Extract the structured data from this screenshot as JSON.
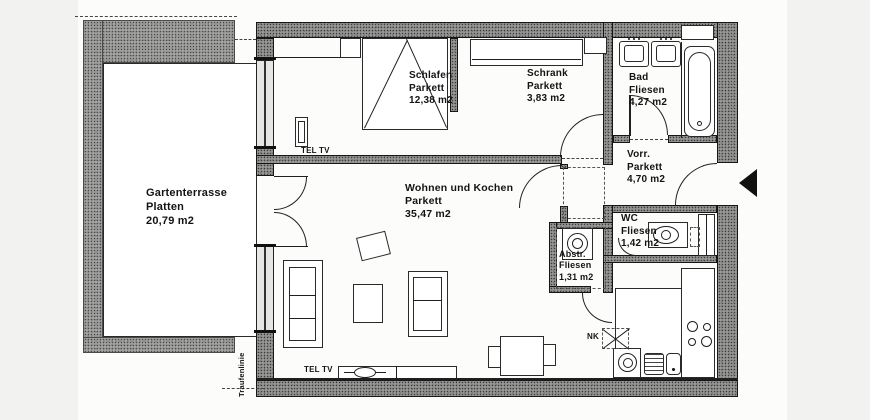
{
  "plan_title": "Apartment floor plan",
  "rooms": {
    "terrace": {
      "name": "Gartenterrasse",
      "floor": "Platten",
      "area": "20,79 m2"
    },
    "schlafen": {
      "name": "Schlafen",
      "floor": "Parkett",
      "area": "12,38 m2"
    },
    "schrank": {
      "name": "Schrank",
      "floor": "Parkett",
      "area": "3,83 m2"
    },
    "bad": {
      "name": "Bad",
      "floor": "Fliesen",
      "area": "4,27 m2"
    },
    "vorraum": {
      "name": "Vorr.",
      "floor": "Parkett",
      "area": "4,70 m2"
    },
    "wc": {
      "name": "WC",
      "floor": "Fliesen",
      "area": "1,42 m2"
    },
    "abstellraum": {
      "name": "Abstr.",
      "floor": "Fliesen",
      "area": "1,31 m2"
    },
    "wohnen": {
      "name": "Wohnen und Kochen",
      "floor": "Parkett",
      "area": "35,47 m2"
    }
  },
  "annotations": {
    "tel_tv": "TEL TV",
    "nk": "NK",
    "eaves_line": "Traufenlinie"
  },
  "icons": {
    "entrance_arrow": "entrance-direction-arrow",
    "bed": "double-bed",
    "bathtub": "bathtub",
    "sinks": "double-washbasin",
    "toilet": "toilet",
    "washer": "washing-machine",
    "stove": "four-burner-stove",
    "kitchen_sink": "kitchen-sink-with-drainer",
    "tv": "tv-set"
  },
  "colors": {
    "background": "#f2f2f0",
    "paper": "#fcfcfb",
    "wall_hatch": "#979795",
    "terrace_hatch": "#a3a3a1",
    "line": "#1f1f1f"
  }
}
